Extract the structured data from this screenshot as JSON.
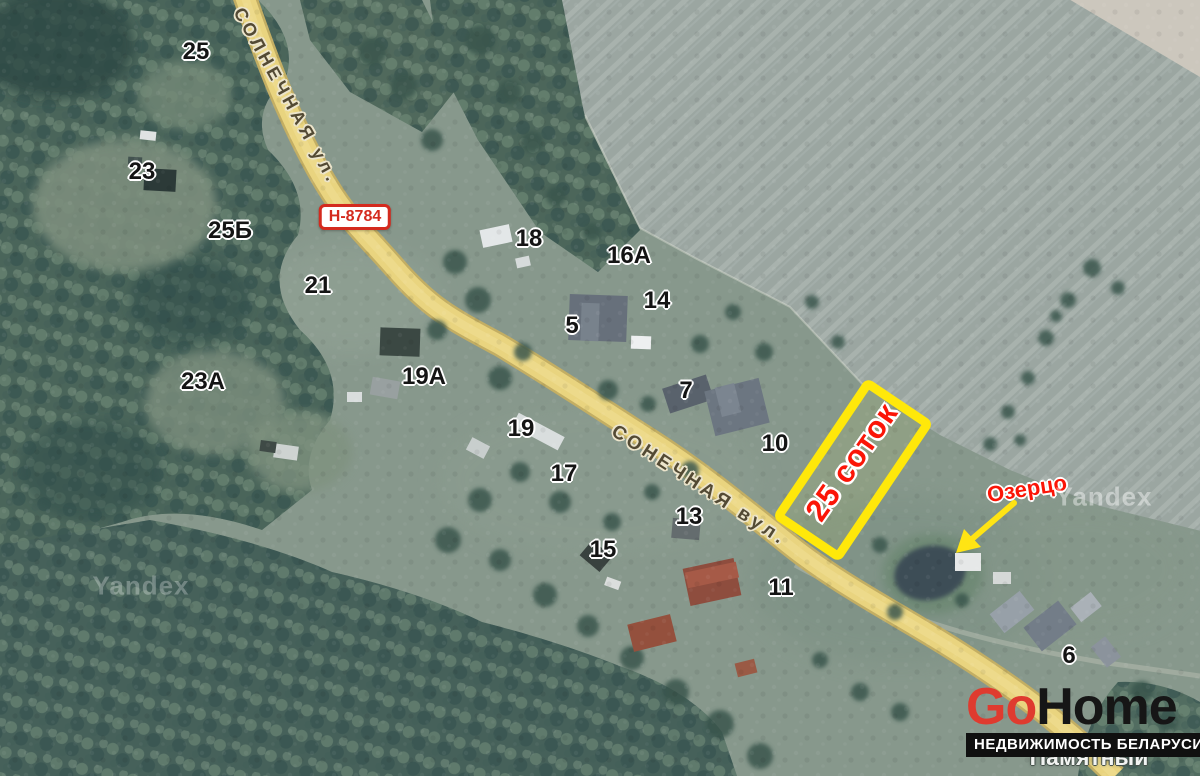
{
  "map": {
    "attribution": [
      {
        "text": "Yandex"
      },
      {
        "text": "Yandex"
      }
    ],
    "road_badge": {
      "text": "Н-8784",
      "color": "#d42a1e"
    },
    "street_labels": [
      {
        "text": "СОЛНЕЧНАЯ ул."
      },
      {
        "text": "СОНЕЧНАЯ вул."
      }
    ],
    "house_numbers": [
      {
        "label": "25",
        "x": 196,
        "y": 52
      },
      {
        "label": "23",
        "x": 142,
        "y": 172
      },
      {
        "label": "25Б",
        "x": 230,
        "y": 231
      },
      {
        "label": "21",
        "x": 318,
        "y": 286
      },
      {
        "label": "23А",
        "x": 203,
        "y": 382
      },
      {
        "label": "19А",
        "x": 424,
        "y": 377
      },
      {
        "label": "19",
        "x": 521,
        "y": 429
      },
      {
        "label": "17",
        "x": 564,
        "y": 474
      },
      {
        "label": "15",
        "x": 603,
        "y": 550
      },
      {
        "label": "13",
        "x": 689,
        "y": 517
      },
      {
        "label": "11",
        "x": 781,
        "y": 588
      },
      {
        "label": "18",
        "x": 529,
        "y": 239
      },
      {
        "label": "16А",
        "x": 629,
        "y": 256
      },
      {
        "label": "14",
        "x": 657,
        "y": 301
      },
      {
        "label": "5",
        "x": 572,
        "y": 326
      },
      {
        "label": "7",
        "x": 686,
        "y": 391
      },
      {
        "label": "10",
        "x": 775,
        "y": 444
      },
      {
        "label": "6",
        "x": 1069,
        "y": 656
      }
    ],
    "plot_highlight": {
      "label": "25 соток",
      "outline_color": "#ffe80a",
      "label_color": "#fb1507"
    },
    "pond_label": {
      "text": "Озерцо",
      "color": "#fb1507"
    },
    "poi_label": {
      "line1": "Памятный",
      "line2": "камень в честь"
    }
  },
  "branding": {
    "logo_part1": "Go",
    "logo_part2": "Home",
    "logo_red": "#df3b2f",
    "logo_black": "#161616",
    "tagline": "НЕДВИЖИМОСТЬ БЕЛАРУСИ"
  }
}
